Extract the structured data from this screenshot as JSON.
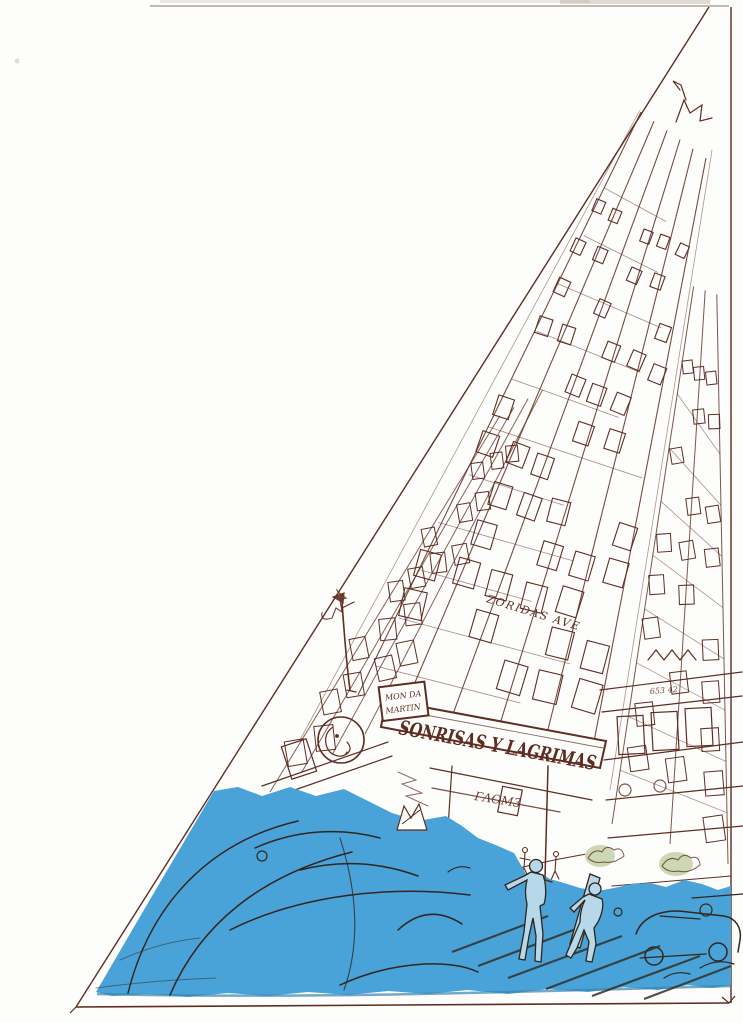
{
  "scene": {
    "description": "Hand-drawn brown-ink sketch of a tall skyscraper seen from street level inside a triangular frame, with a flat blue watercolor wash over cars, crosswalk and two pedestrians in the foreground",
    "marquee": {
      "text": "SONRISAS Y LAGRIMAS",
      "plate_line1": "MON DA",
      "plate_line2": "MARTIN"
    },
    "street_sign": "ZORIDAS AVE",
    "storefront_scribble": "ΓΛΟM3",
    "shop_scribble": "653 42",
    "colors": {
      "ink": "#5e2d20",
      "ink_dark": "#33261e",
      "wash_blue": "#49a3d8",
      "wash_edge": "#3884b0",
      "figure_blue": "#b7d8e9",
      "bush_green": "#ccd8b4",
      "paper": "#fdfdfc"
    }
  }
}
